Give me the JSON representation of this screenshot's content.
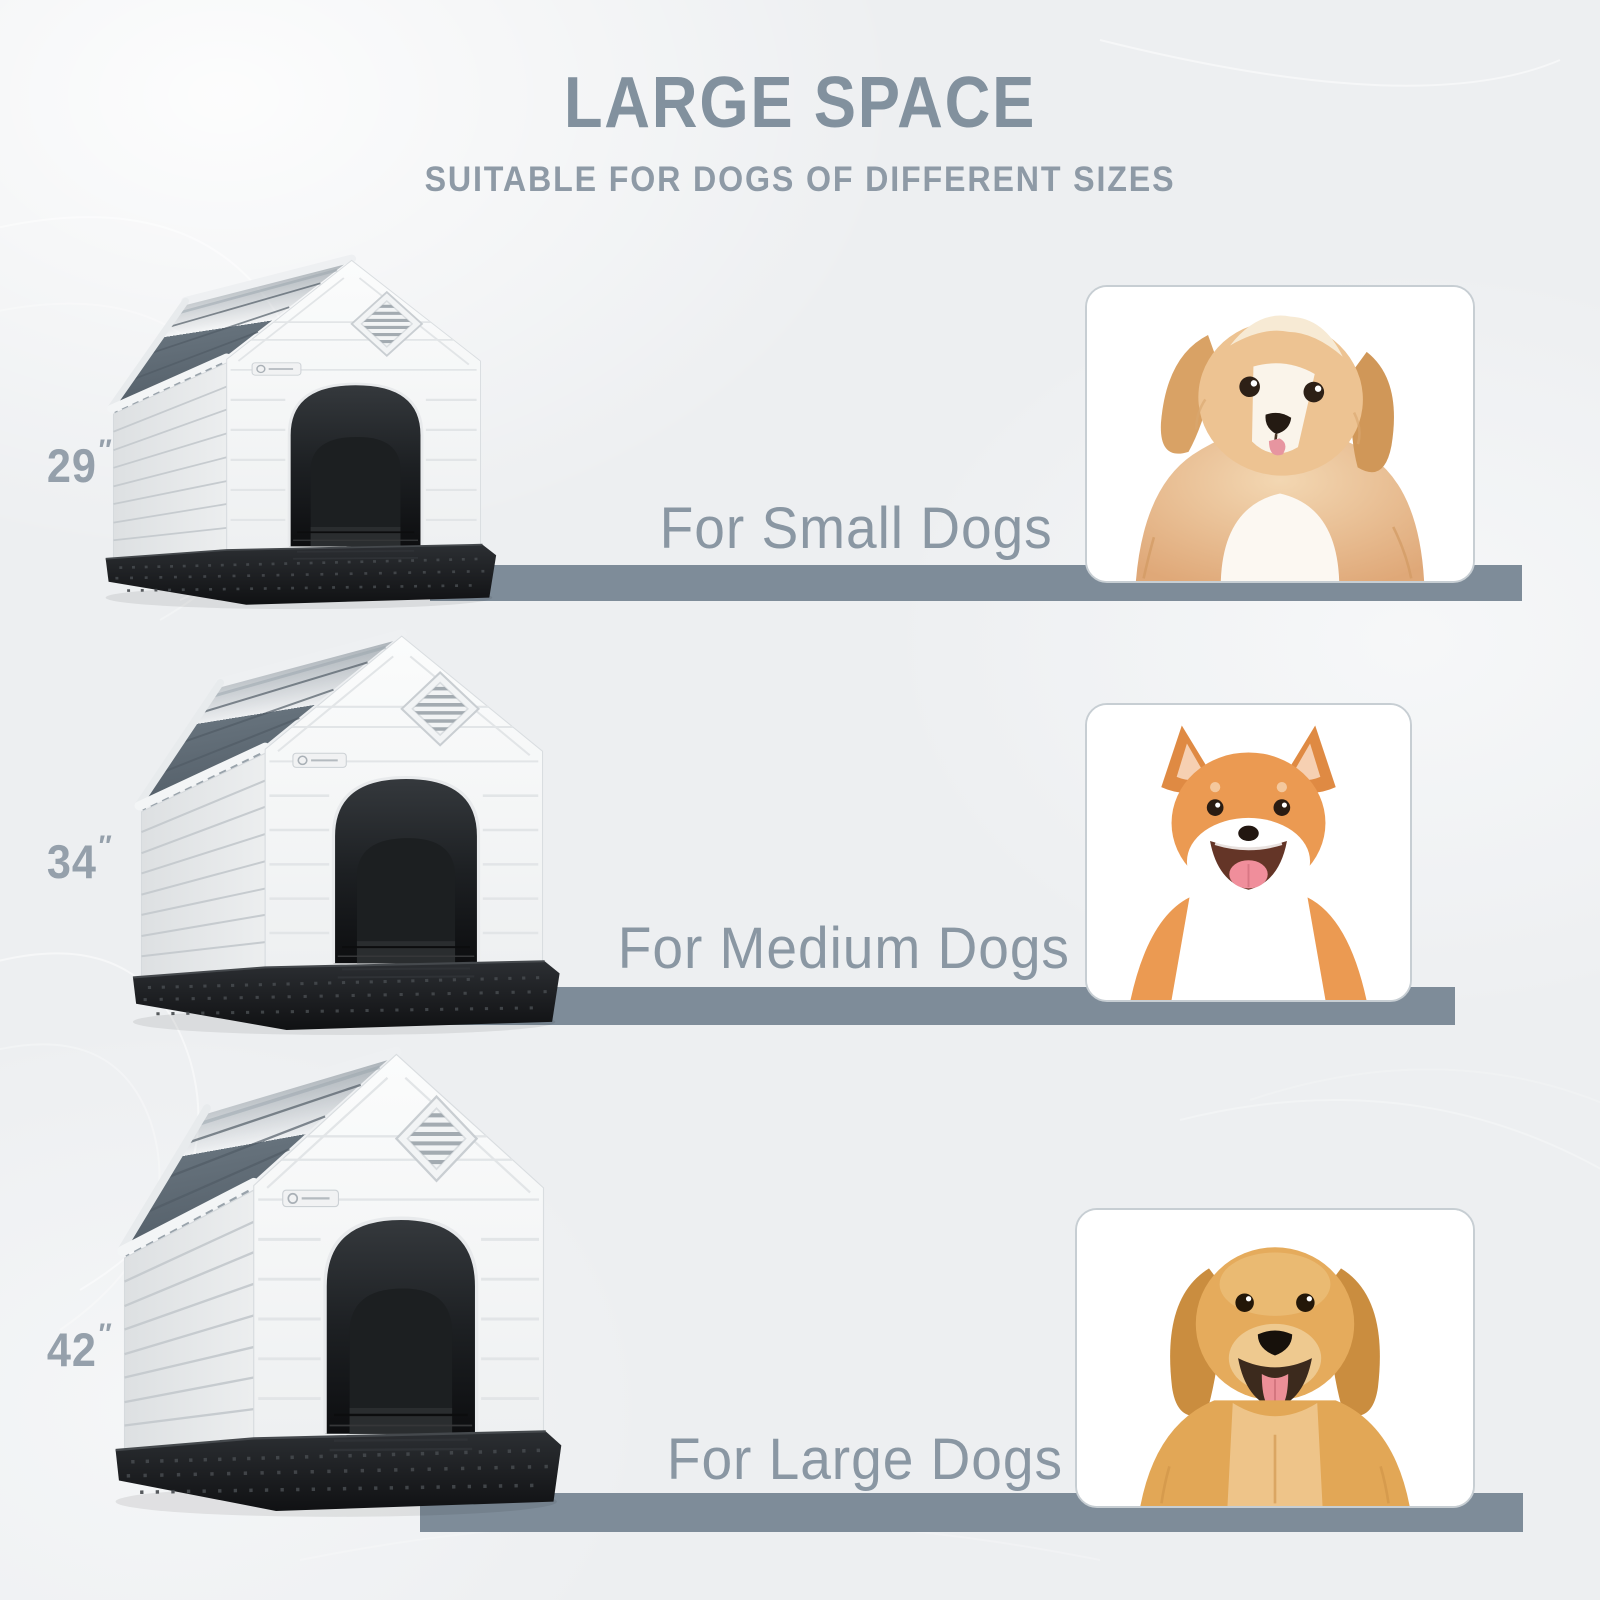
{
  "header": {
    "title": "LARGE SPACE",
    "subtitle": "SUITABLE FOR DOGS OF DIFFERENT SIZES"
  },
  "rows": [
    {
      "size_value": "29",
      "size_unit": "″",
      "label": "For Small Dogs",
      "dog_icon": "small-fluffy-puppy-photo",
      "house_icon": "dog-house-29-inch"
    },
    {
      "size_value": "34",
      "size_unit": "″",
      "label": "For Medium Dogs",
      "dog_icon": "shiba-inu-photo",
      "house_icon": "dog-house-34-inch"
    },
    {
      "size_value": "42",
      "size_unit": "″",
      "label": "For Large Dogs",
      "dog_icon": "golden-retriever-photo",
      "house_icon": "dog-house-42-inch"
    }
  ],
  "colors": {
    "accent_bar": "#7e8c99",
    "title_text": "#82919e",
    "subtitle_text": "#8e9aa6",
    "label_text": "#8a97a3",
    "size_text": "#95a0ab",
    "background": "#edeff1",
    "card_background": "#ffffff",
    "house_roof": "#6a7680",
    "house_body": "#f6f7f8",
    "house_base": "#17191b"
  }
}
